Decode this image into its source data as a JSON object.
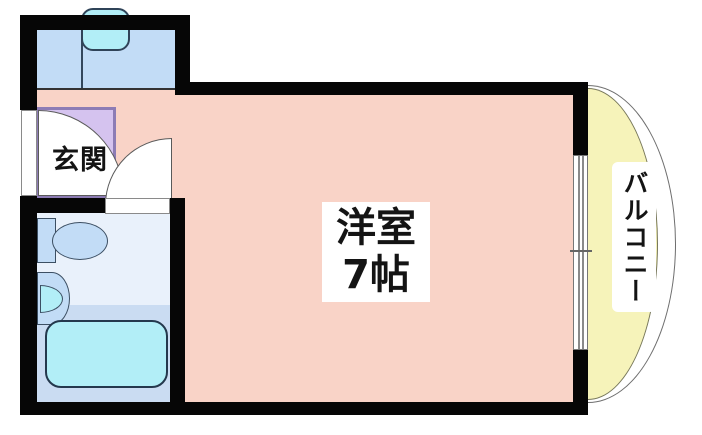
{
  "floorplan": {
    "rooms": {
      "genkan": {
        "label": "玄関",
        "mat_color": "#d5c3ef"
      },
      "main_room": {
        "name": "洋室",
        "size": "7帖",
        "floor_color": "#f9d3c7"
      },
      "balcony": {
        "label": "バルコニー",
        "floor_color": "#f6f3ba"
      },
      "bathroom": {
        "floor_color_upper": "#e9f1fb",
        "floor_color_lower": "#cadcf2"
      },
      "kitchen": {
        "counter_color": "#c2dcf6",
        "sink_color": "#b2eef7"
      }
    },
    "fixtures": [
      "kitchen-sink",
      "toilet",
      "washbasin",
      "bathtub",
      "entrance-door",
      "interior-door",
      "sliding-window"
    ],
    "colors": {
      "wall": "#060606",
      "fixture_blue": "#c2dcf6",
      "fixture_cyan": "#b2eef7",
      "outline": "#3c4f63"
    }
  }
}
